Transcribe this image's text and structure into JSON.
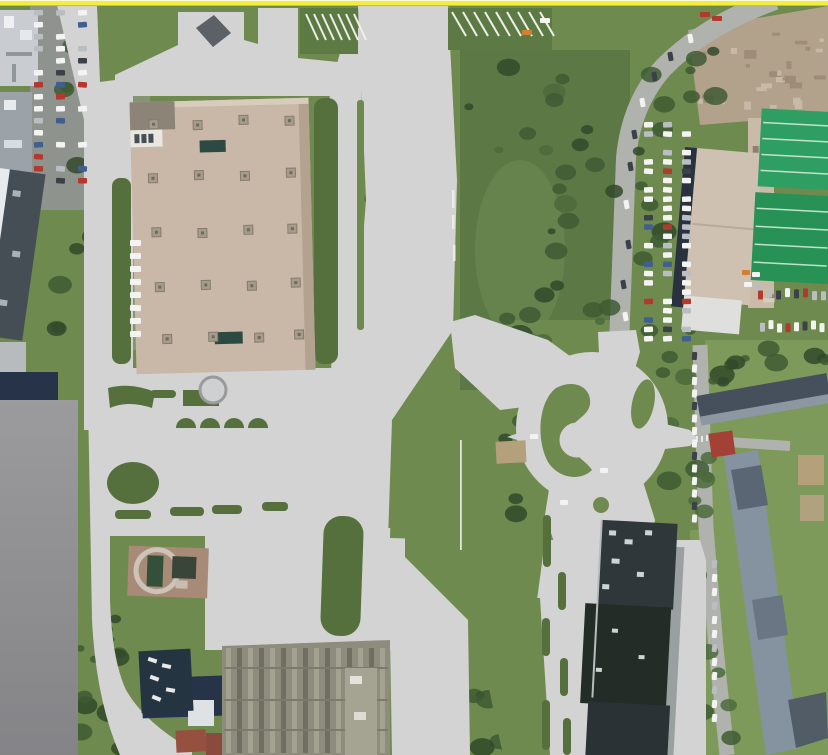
{
  "canvas": {
    "width": 828,
    "height": 755
  },
  "colors": {
    "top_line": "#f2ee3a",
    "top_line_hi": "#fbf9dc",
    "top_line_edge": "#c9c22e",
    "overlay": "#d3d3d4",
    "panel_top": "#9b9b9d",
    "panel_bottom": "#848487",
    "grass": "#6f8a4e",
    "grass_light": "#7e9a5b",
    "grass_dark": "#55703d",
    "forest": "#5c7844",
    "tree": "#3e5a33",
    "tree_dark": "#31492a",
    "street": "#b0b2ad",
    "street_dark": "#8f938d",
    "mall_roof": "#c9b8a7",
    "mall_shade": "#b3a290",
    "mall_dark_wing": "#8d8478",
    "mall_white": "#e9e7e1",
    "mall_vent": "#a59c8b",
    "mall_vent_dot": "#6f685c",
    "mall_dock": "#2c4a42",
    "beige_bldg": "#cfc1b1",
    "navy_edge": "#29323e",
    "green_roof": "#2f9e62",
    "green_roof2": "#289156",
    "dirt": "#b2a28c",
    "dirt_light": "#c9bba7",
    "white_bldg": "#c9cdd1",
    "gray_bldg": "#9ba3a9",
    "dark_roof_bldg": "#454d55",
    "navy_roof": "#273349",
    "water": "#243441",
    "yard": "#8e8c7d",
    "yard_dark": "#6b6a5e",
    "yard_light": "#a5a392",
    "complex_top": "#30373b",
    "complex_mid": "#232c27",
    "complex_low": "#2a3235",
    "complex_wing": "#9aa0a0",
    "resid_dark": "#46505c",
    "resid_light": "#8593a1",
    "red_roof": "#a34136",
    "red_house": "#96503f",
    "plot": "#a78b77",
    "ring": "#cec3b8",
    "sand": "#b5a07c",
    "car_white": "#f3f4f2",
    "car_silver": "#b9bec2",
    "car_dark": "#3a4148",
    "car_red": "#b2392e",
    "car_blue": "#3f5f8f",
    "car_orange": "#d08030",
    "stripe_white": "#eef0ea"
  }
}
